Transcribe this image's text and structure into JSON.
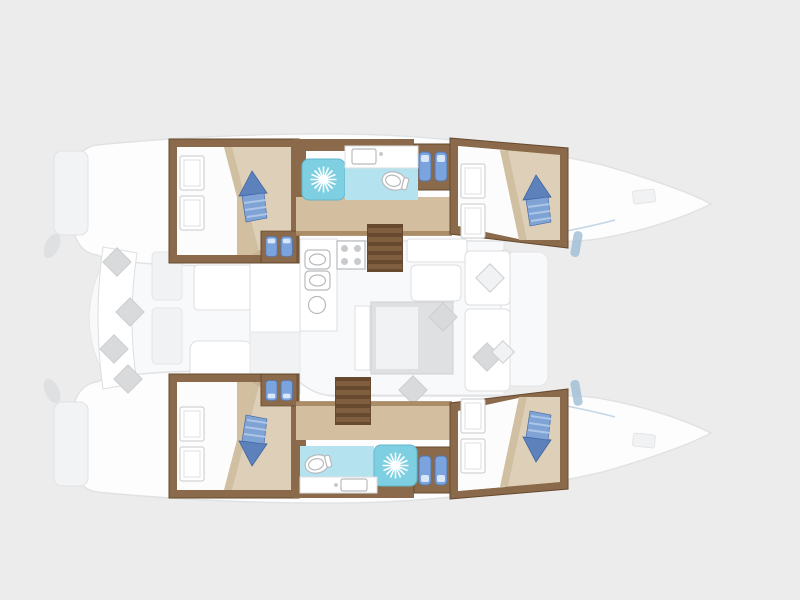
{
  "colors": {
    "bg": "#ececec",
    "hullFill": "#fdfdfe",
    "hullStroke": "#e1e2e4",
    "platformFill": "#f2f3f4",
    "deckFill": "#f8f9fa",
    "deckStroke": "#e4e5e7",
    "furnWhite": "#ffffff",
    "furnStroke": "#dddee0",
    "fadedFill": "#f1f2f3",
    "tableFill": "#dfe0e2",
    "pillowGray": "#d9dadc",
    "pillowStroke": "#cdced0",
    "wood": "#8a6a4a",
    "woodDark": "#66492e",
    "woodMid": "#7f5f40",
    "woodLight": "#a08057",
    "floorTan": "#d3bf9f",
    "bedBeige": "#ded0b8",
    "bedBeigeDark": "#c8b493",
    "sheetWhite": "#fcfcfc",
    "showerCyan": "#7ecfe2",
    "showerStroke": "#62b7cb",
    "bathFloorCyan": "#b4e2ee",
    "fixStroke": "#b7babd",
    "cushionBlue": "#7ba3dd",
    "cushionBlueDark": "#5578b2",
    "cushionGlint": "#d9e6f8",
    "arrowBlue": "#5c81bb",
    "arrowBase": "#7fa3d4",
    "arrowStripe": "#adc6e8",
    "arrowDark": "#3f63a2",
    "accentBlue": "#9dbdd6"
  },
  "icons": [
    "shower-sun-icon",
    "berth-arrow-pillow-icon",
    "seat-cushion-pair-icon",
    "stairs-icon",
    "toilet-icon",
    "sink-icon",
    "stove-burners-icon",
    "bow-hatch-icon"
  ],
  "plan": {
    "vessel": "catamaran",
    "view": "top-down interior deck plan, bow pointing right",
    "hulls": [
      {
        "side": "port",
        "position": "top",
        "spaces": [
          "aft-double-cabin",
          "head-with-shower-and-toilet",
          "companionway-stairs",
          "forward-double-cabin"
        ]
      },
      {
        "side": "starboard",
        "position": "bottom",
        "spaces": [
          "aft-double-cabin",
          "head-with-shower-and-toilet",
          "companionway-stairs",
          "forward-double-cabin"
        ]
      }
    ],
    "bridgedeck": [
      "aft-cockpit-bench",
      "cockpit-table",
      "galley-with-stove-and-sinks",
      "salon-table",
      "salon-seating",
      "windshield",
      "forward-cockpit"
    ],
    "counts": {
      "cabins": 4,
      "heads": 2,
      "showers": 2,
      "berth-arrow-pillows": 4,
      "swim-platforms": 2
    }
  }
}
